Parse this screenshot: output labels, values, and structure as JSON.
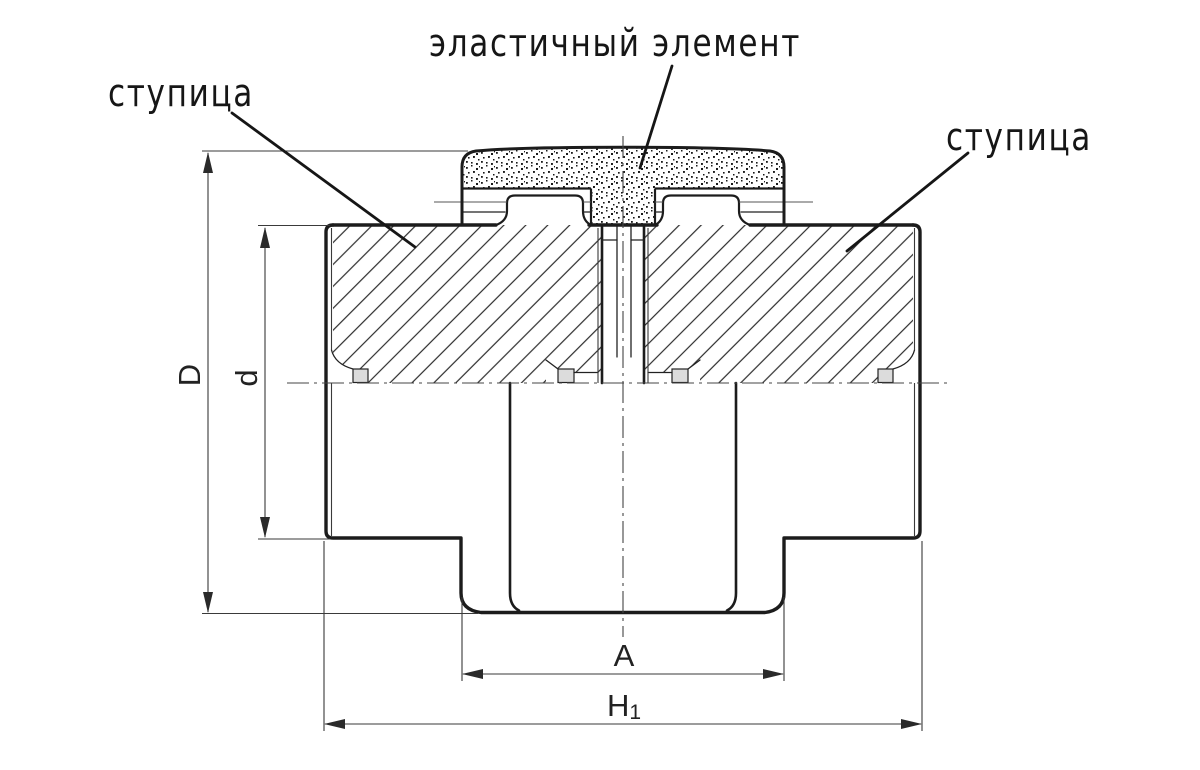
{
  "drawing": {
    "callouts": {
      "elastic_element": "эластичный элемент",
      "hub_left": "ступица",
      "hub_right": "ступица"
    },
    "dimensions": {
      "outer_diameter": "D",
      "hub_diameter": "d",
      "flange_width": "A",
      "total_length": "H",
      "total_length_subscript": "1"
    },
    "colors": {
      "background": "#ffffff",
      "line": "#1c1c1c",
      "thin_line": "#3a3a3a",
      "groove_fill": "#dcdcdc"
    }
  }
}
